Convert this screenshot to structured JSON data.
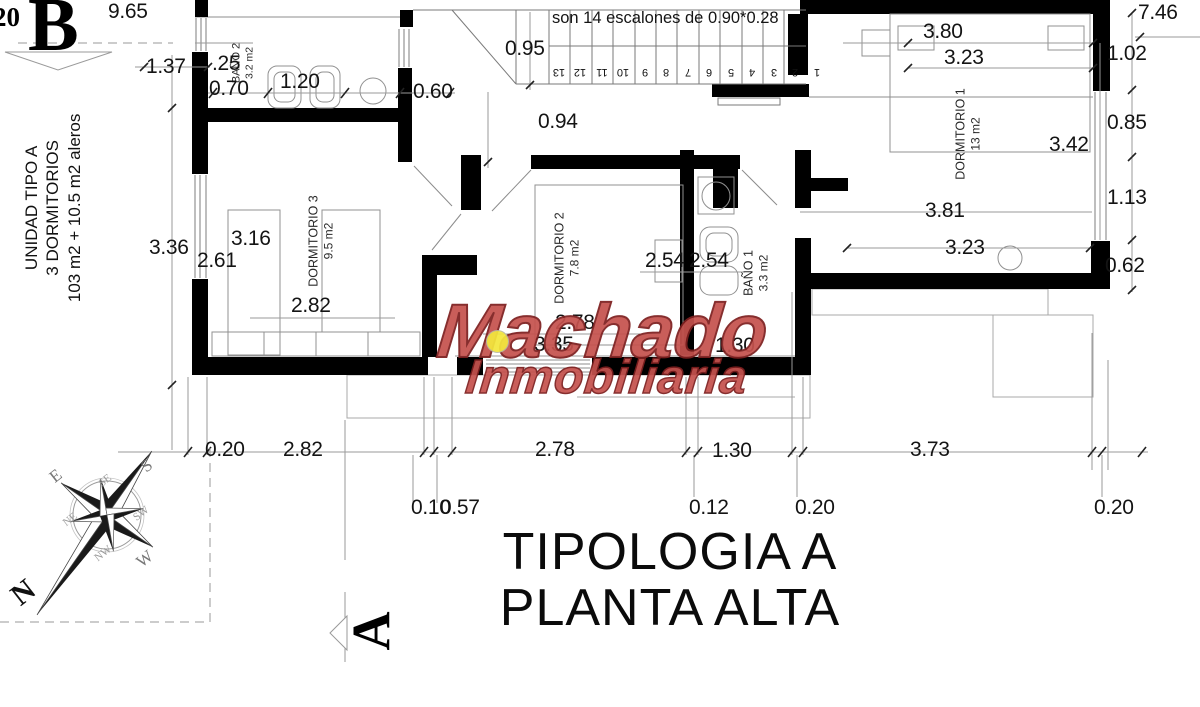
{
  "title": {
    "line1": "TIPOLOGIA A",
    "line2": "PLANTA ALTA"
  },
  "unit_info": {
    "line1": "UNIDAD TIPO A",
    "line2": "3 DORMITORIOS",
    "line3": "103 m2 + 10.5 m2 aleros"
  },
  "stairs": {
    "note": "son 14 escalones de 0.90*0.28",
    "step_numbers": [
      "13",
      "12",
      "11",
      "10",
      "9",
      "8",
      "7",
      "6",
      "5",
      "4",
      "3",
      "2",
      "1"
    ]
  },
  "rooms": [
    {
      "name": "BAÑO 2",
      "area": "3.2 m2"
    },
    {
      "name": "DORMITORIO 3",
      "area": "9.5 m2"
    },
    {
      "name": "DORMITORIO 2",
      "area": "7.8 m2"
    },
    {
      "name": "BAÑO 1",
      "area": "3.3 m2"
    },
    {
      "name": "DORMITORIO 1",
      "area": "13 m2"
    }
  ],
  "section_markers": {
    "b": "B",
    "a": "A",
    "edge_fragment": "20"
  },
  "compass": {
    "n": "N",
    "s": "S",
    "e": "E",
    "w": "W",
    "ne": "NE",
    "se": "SE",
    "sw": "SW",
    "nw": "NW"
  },
  "watermark": {
    "line1": "Machado",
    "line2": "Inmobiliaria",
    "color": "#c5524e",
    "accent_dot": "#f4e73e"
  },
  "dimensions": {
    "d1": "9.65",
    "d2": "1.37",
    "d3": ".25",
    "d4": "0.70",
    "d5": "1.20",
    "d6": "0.60",
    "d7": "0.95",
    "d8": "0.94",
    "d9": "3.80",
    "d10": "3.23",
    "d11": "7.46",
    "d12": "1.02",
    "d13": "0.85",
    "d14": "3.42",
    "d15": "1.13",
    "d16": "3.81",
    "d17": "3.23",
    "d18": "0.62",
    "d19": "3.36",
    "d20": "2.61",
    "d21": "3.16",
    "d22": "2.82",
    "d23": "2.54",
    "d24": "2.54",
    "d25": "2.78",
    "d26": "3.35",
    "d27": "1.30",
    "d28": "0.20",
    "d29": "2.82",
    "d30": "2.78",
    "d31": "1.30",
    "d32": "3.73",
    "d33": "0.10",
    "d34": "0.57",
    "d35": "0.12",
    "d36": "0.20",
    "d37": "0.20"
  }
}
